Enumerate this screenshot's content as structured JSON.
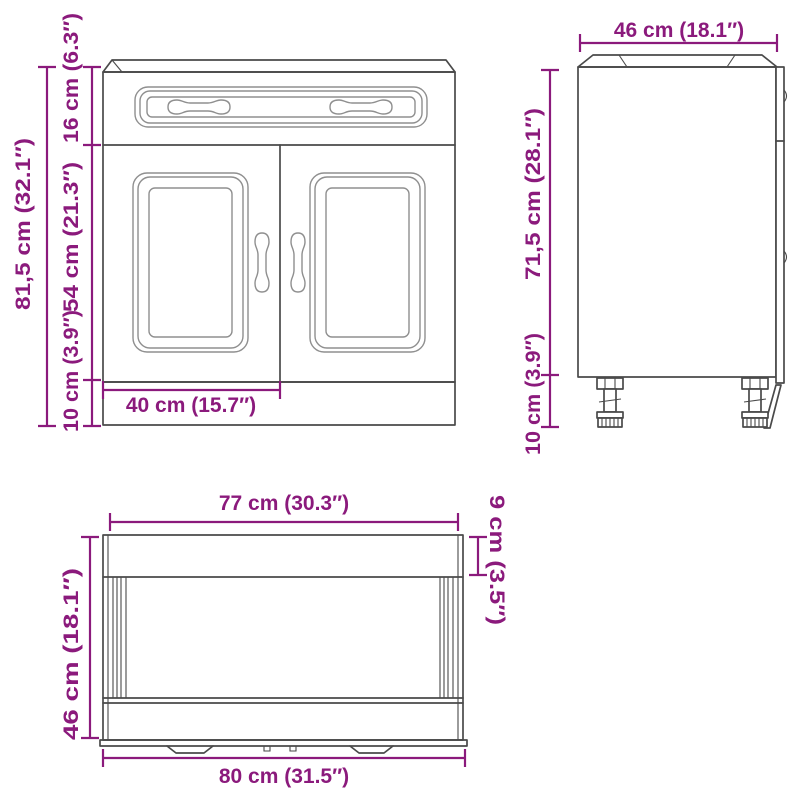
{
  "colors": {
    "dimension": "#8b1a7c",
    "outline": "#4a4a4a",
    "detail": "#8f8f8f",
    "background": "#ffffff"
  },
  "front_view": {
    "height_total": "81,5 cm (32.1″)",
    "height_drawer": "16 cm (6.3″)",
    "height_doors": "54 cm (21.3″)",
    "height_legs": "10 cm (3.9″)",
    "width_door": "40 cm (15.7″)"
  },
  "side_view": {
    "depth": "46 cm (18.1″)",
    "height_body": "71,5 cm (28.1″)",
    "height_legs": "10 cm (3.9″)"
  },
  "top_view": {
    "width_top": "77 cm (30.3″)",
    "overhang_depth": "9 cm (3.5″)",
    "depth": "46 cm (18.1″)",
    "width_total": "80 cm (31.5″)"
  }
}
